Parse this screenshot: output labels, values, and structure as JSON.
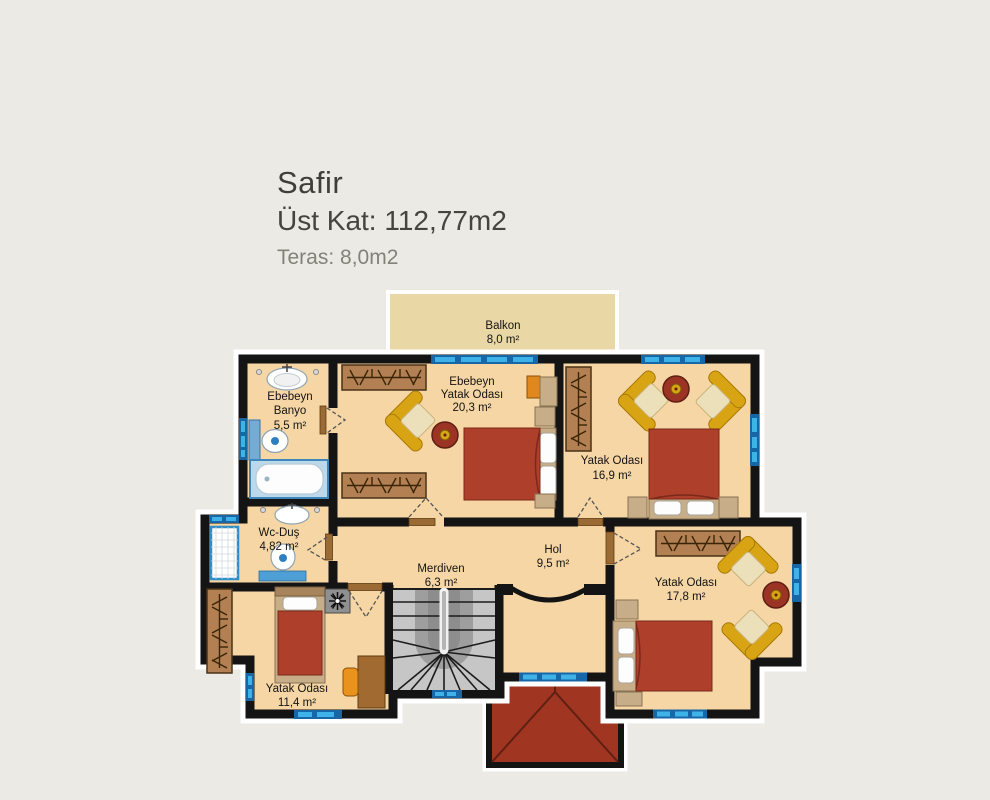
{
  "header": {
    "project": "Safir",
    "floor_line": "Üst Kat: 112,77m2",
    "terrace_line": "Teras: 8,0m2"
  },
  "rooms": {
    "balkon": {
      "name": "Balkon",
      "area": "8,0 m²"
    },
    "ebebeyn_banyo": {
      "line1": "Ebebeyn",
      "line2": "Banyo",
      "area": "5,5 m²"
    },
    "ebebeyn_yatak_odasi": {
      "line1": "Ebebeyn",
      "line2": "Yatak Odası",
      "area": "20,3 m²"
    },
    "yatak_odasi_16": {
      "name": "Yatak Odası",
      "area": "16,9 m²"
    },
    "wc_dus": {
      "name": "Wc-Duş",
      "area": "4,82 m²"
    },
    "merdiven": {
      "name": "Merdiven",
      "area": "6,3 m²"
    },
    "hol": {
      "name": "Hol",
      "area": "9,5 m²"
    },
    "yatak_odasi_17": {
      "name": "Yatak Odası",
      "area": "17,8 m²"
    },
    "yatak_odasi_11": {
      "name": "Yatak Odası",
      "area": "11,4 m²"
    }
  },
  "colors": {
    "background": "#ebeae4",
    "floor": "#f5d6a4",
    "balcony_floor": "#ead7a6",
    "wall": "#141414",
    "window_blue": "#3fb2e8",
    "window_frame_blue": "#1767a8",
    "bed_red": "#ae3f2a",
    "roof_red": "#a03522",
    "furniture_gold": "#d8a414",
    "wardrobe_brown": "#b28052",
    "stair_gray": "#c6c6c6"
  }
}
